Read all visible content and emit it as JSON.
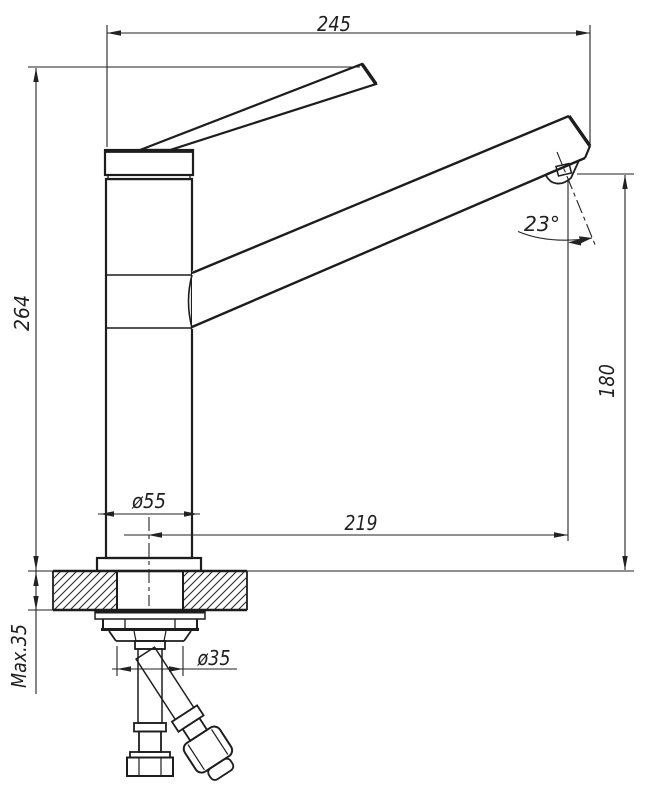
{
  "drawing": {
    "background": "#ffffff",
    "line_color": "#1d1d1d",
    "labels": {
      "overall_width": "245",
      "overall_height": "264",
      "outlet_height": "180",
      "spout_reach": "219",
      "body_diameter": "ø55",
      "hole_diameter": "ø35",
      "max_mount_thickness": "Max.35",
      "outlet_angle": "23°"
    }
  }
}
